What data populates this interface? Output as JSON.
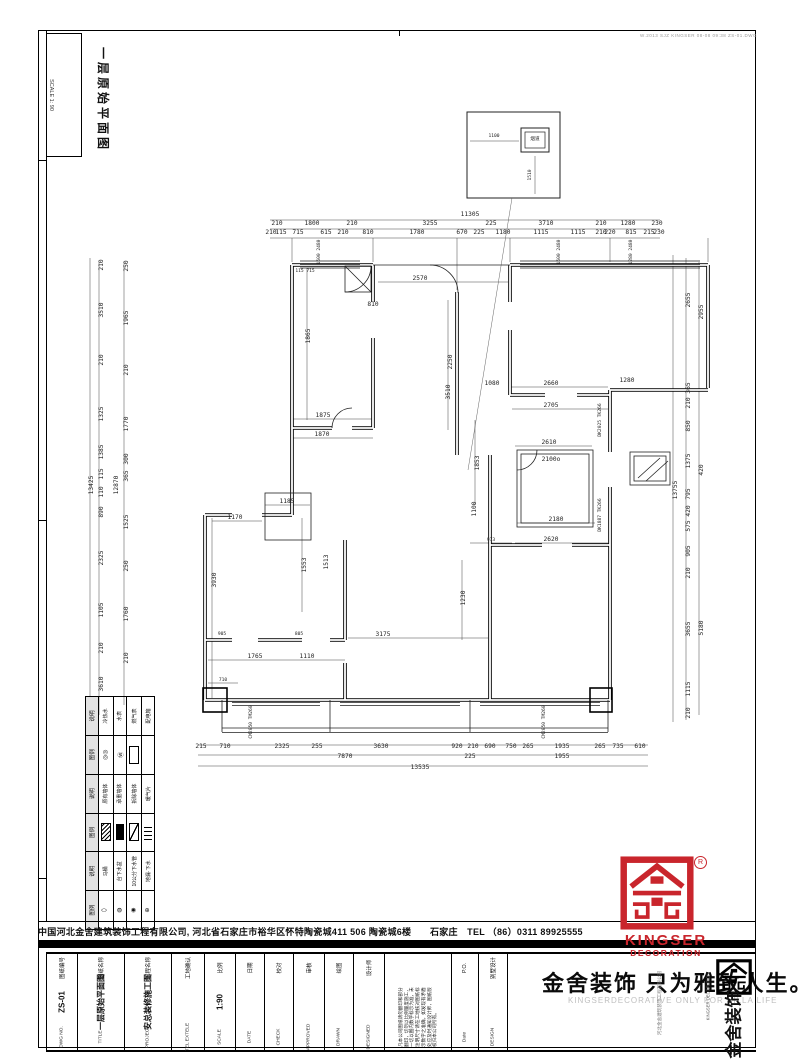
{
  "sheet": {
    "title_vertical": "一层原始平面图",
    "scale_label": "SCALE 1: 90",
    "plot_stamp": "W.2013 SJZ KINGSER 08-08 09:38 ZS-01.DWG"
  },
  "company_bar": {
    "text": "中国河北金舍建筑装饰工程有限公司, 河北省石家庄市裕华区怀特陶瓷城411 506 陶瓷城6楼　　石家庄　TEL （86）0311 89925555"
  },
  "logo": {
    "brand": "KINGSER",
    "sub": "DECORATION",
    "registered": "R",
    "accent_color": "#c9252c",
    "black_logo_text": "金舍装饰",
    "stamp_vertical": "KINGSER DECORATION"
  },
  "slogan": {
    "cn": "金舍装饰 只为雅致人生。",
    "en": "KINGSERDECORATIVE ONLY FOR VILLA LIFE",
    "company_vertical": "河北金舍建筑装饰工程有限公司"
  },
  "titleblock": {
    "fields": [
      {
        "cn": "图纸编号",
        "value": "ZS-01",
        "en": "DWG NO.",
        "w": 30
      },
      {
        "cn": "图纸名称",
        "value": "一层原始平面图",
        "en": "TITLE",
        "w": 46
      },
      {
        "cn": "工程名称",
        "value": "安总装修施工图",
        "en": "PROJECT",
        "w": 46
      },
      {
        "cn": "工地确认",
        "value": "",
        "en": "TEL EXTELE",
        "w": 32
      },
      {
        "cn": "比例",
        "value": "1:90",
        "en": "SCALE",
        "w": 30
      },
      {
        "cn": "日期",
        "value": "",
        "en": "DATE",
        "w": 28
      },
      {
        "cn": "校对",
        "value": "",
        "en": "CHECK",
        "w": 28
      },
      {
        "cn": "审核",
        "value": "",
        "en": "APPROVED",
        "w": 30
      },
      {
        "cn": "绘图",
        "value": "",
        "en": "DRAWN",
        "w": 28
      },
      {
        "cn": "设计师",
        "value": "",
        "en": "DESIGNED",
        "w": 30
      },
      {
        "cn": "",
        "value": "",
        "en": "DESIGN NOTE",
        "w": 66,
        "disclaimer": true
      },
      {
        "cn": "P.O.",
        "value": "",
        "en": "Date",
        "w": 26
      },
      {
        "cn": "别墅设计",
        "value": "",
        "en": "DESIGN",
        "w": 28
      }
    ],
    "disclaimer_lines": [
      "凡本公司图纸请勿翻印和部分",
      "翻印，切勿以比例量度施工，",
      "一切以图内数字标示为准，未",
      "注明尺寸请在工地核对图纸标",
      "示数字之准确，如发现有矛盾",
      "处应及时通知设计师，图纸版",
      "权归本公司所有。"
    ]
  },
  "legend": {
    "headers": [
      "图例",
      "说明"
    ],
    "groups": [
      [
        [
          "toilet",
          "马桶"
        ],
        [
          "sink",
          "台下水盆"
        ],
        [
          "pipe",
          "10公分下水管"
        ],
        [
          "drain",
          "地漏·下水"
        ]
      ],
      [
        [
          "hatch",
          "原有墙体"
        ],
        [
          "solid",
          "承重墙体"
        ],
        [
          "diag",
          "拆除墙体"
        ],
        [
          "lines",
          "暖气片"
        ]
      ],
      [
        [
          "c1",
          "冷热水"
        ],
        [
          "c2",
          "水表"
        ],
        [
          "rect",
          "燃气表"
        ],
        [
          "none",
          "配电箱"
        ]
      ]
    ]
  },
  "plan": {
    "inset_label": "烟道",
    "labels": [
      [
        470,
        216,
        "11305"
      ],
      [
        277,
        225,
        "210"
      ],
      [
        312,
        225,
        "1800"
      ],
      [
        352,
        225,
        "210"
      ],
      [
        430,
        225,
        "3255"
      ],
      [
        491,
        225,
        "225"
      ],
      [
        546,
        225,
        "3710"
      ],
      [
        601,
        225,
        "210"
      ],
      [
        628,
        225,
        "1280"
      ],
      [
        657,
        225,
        "230"
      ],
      [
        271,
        234,
        "210"
      ],
      [
        281,
        234,
        "115"
      ],
      [
        298,
        234,
        "715"
      ],
      [
        326,
        234,
        "615"
      ],
      [
        343,
        234,
        "210"
      ],
      [
        368,
        234,
        "810"
      ],
      [
        417,
        234,
        "1780"
      ],
      [
        462,
        234,
        "670"
      ],
      [
        479,
        234,
        "225"
      ],
      [
        503,
        234,
        "1180"
      ],
      [
        541,
        234,
        "1115"
      ],
      [
        578,
        234,
        "1115"
      ],
      [
        601,
        234,
        "210"
      ],
      [
        610,
        234,
        "220"
      ],
      [
        631,
        234,
        "815"
      ],
      [
        649,
        234,
        "215"
      ],
      [
        659,
        234,
        "230"
      ],
      [
        320,
        252,
        "1500 2480",
        "sv"
      ],
      [
        560,
        252,
        "1500 2480",
        "sv"
      ],
      [
        632,
        252,
        "1280 2480",
        "sv"
      ],
      [
        201,
        748,
        "215"
      ],
      [
        225,
        748,
        "710"
      ],
      [
        282,
        748,
        "2325"
      ],
      [
        317,
        748,
        "255"
      ],
      [
        381,
        748,
        "3630"
      ],
      [
        457,
        748,
        "920"
      ],
      [
        473,
        748,
        "210"
      ],
      [
        490,
        748,
        "690"
      ],
      [
        511,
        748,
        "750"
      ],
      [
        528,
        748,
        "265"
      ],
      [
        562,
        748,
        "1935"
      ],
      [
        600,
        748,
        "265"
      ],
      [
        618,
        748,
        "735"
      ],
      [
        640,
        748,
        "610"
      ],
      [
        345,
        758,
        "7870"
      ],
      [
        470,
        758,
        "225"
      ],
      [
        562,
        758,
        "1955"
      ],
      [
        420,
        769,
        "13535"
      ],
      [
        252,
        722,
        "CM2050 TM260",
        "sv"
      ],
      [
        545,
        722,
        "CM2050 TM260",
        "sv"
      ],
      [
        103,
        265,
        "210",
        "v"
      ],
      [
        103,
        310,
        "3510",
        "v"
      ],
      [
        103,
        360,
        "210",
        "v"
      ],
      [
        103,
        414,
        "1325",
        "v"
      ],
      [
        103,
        452,
        "1385",
        "v"
      ],
      [
        103,
        474,
        "115",
        "v"
      ],
      [
        103,
        492,
        "110",
        "v"
      ],
      [
        103,
        512,
        "890",
        "v"
      ],
      [
        103,
        558,
        "2325",
        "v"
      ],
      [
        103,
        610,
        "1105",
        "v"
      ],
      [
        103,
        648,
        "210",
        "v"
      ],
      [
        103,
        684,
        "3610",
        "v"
      ],
      [
        93,
        485,
        "13425",
        "v"
      ],
      [
        128,
        266,
        "250",
        "v"
      ],
      [
        128,
        318,
        "1965",
        "v"
      ],
      [
        128,
        370,
        "210",
        "v"
      ],
      [
        128,
        424,
        "1770",
        "v"
      ],
      [
        128,
        459,
        "300",
        "v"
      ],
      [
        128,
        476,
        "365",
        "v"
      ],
      [
        128,
        522,
        "1525",
        "v"
      ],
      [
        128,
        566,
        "250",
        "v"
      ],
      [
        128,
        614,
        "1760",
        "v"
      ],
      [
        128,
        658,
        "210",
        "v"
      ],
      [
        118,
        485,
        "12870",
        "v"
      ],
      [
        690,
        300,
        "2655",
        "v"
      ],
      [
        690,
        388,
        "365",
        "v"
      ],
      [
        690,
        403,
        "210",
        "v"
      ],
      [
        690,
        426,
        "850",
        "v"
      ],
      [
        690,
        461,
        "1375",
        "v"
      ],
      [
        690,
        494,
        "795",
        "v"
      ],
      [
        690,
        511,
        "420",
        "v"
      ],
      [
        690,
        526,
        "575",
        "v"
      ],
      [
        690,
        551,
        "905",
        "v"
      ],
      [
        690,
        573,
        "210",
        "v"
      ],
      [
        690,
        629,
        "3655",
        "v"
      ],
      [
        690,
        689,
        "1115",
        "v"
      ],
      [
        690,
        713,
        "210",
        "v"
      ],
      [
        677,
        490,
        "13755",
        "v"
      ],
      [
        703,
        312,
        "2955",
        "v"
      ],
      [
        703,
        470,
        "420",
        "v"
      ],
      [
        703,
        628,
        "5180",
        "v"
      ],
      [
        310,
        336,
        "1865",
        "v"
      ],
      [
        420,
        280,
        "2570"
      ],
      [
        373,
        306,
        "810"
      ],
      [
        305,
        272,
        "115 715",
        "s"
      ],
      [
        452,
        362,
        "2250",
        "v"
      ],
      [
        450,
        392,
        "3510",
        "v"
      ],
      [
        323,
        417,
        "1875"
      ],
      [
        322,
        436,
        "1870"
      ],
      [
        235,
        519,
        "1170"
      ],
      [
        287,
        503,
        "1185"
      ],
      [
        216,
        580,
        "3930",
        "v"
      ],
      [
        306,
        565,
        "1553",
        "v"
      ],
      [
        328,
        562,
        "1513",
        "v"
      ],
      [
        255,
        658,
        "1765"
      ],
      [
        307,
        658,
        "1110"
      ],
      [
        222,
        635,
        "905",
        "s"
      ],
      [
        299,
        635,
        "805",
        "s"
      ],
      [
        383,
        636,
        "3175"
      ],
      [
        223,
        681,
        "710",
        "s"
      ],
      [
        491,
        541,
        "973",
        "s"
      ],
      [
        551,
        541,
        "2620"
      ],
      [
        556,
        521,
        "2180"
      ],
      [
        551,
        461,
        "2100o"
      ],
      [
        549,
        444,
        "2610"
      ],
      [
        551,
        407,
        "2705"
      ],
      [
        551,
        385,
        "2660"
      ],
      [
        492,
        385,
        "1080"
      ],
      [
        627,
        382,
        "1280"
      ],
      [
        479,
        463,
        "1853",
        "v"
      ],
      [
        476,
        509,
        "1100",
        "v"
      ],
      [
        465,
        598,
        "1230",
        "v"
      ],
      [
        601,
        420,
        "DK2025 TK266",
        "sv"
      ],
      [
        601,
        515,
        "DK1887 TK266",
        "sv"
      ],
      [
        494,
        137,
        "1100",
        "s"
      ],
      [
        531,
        175,
        "1510",
        "sv"
      ],
      [
        535,
        140,
        "烟道",
        "s"
      ]
    ]
  }
}
